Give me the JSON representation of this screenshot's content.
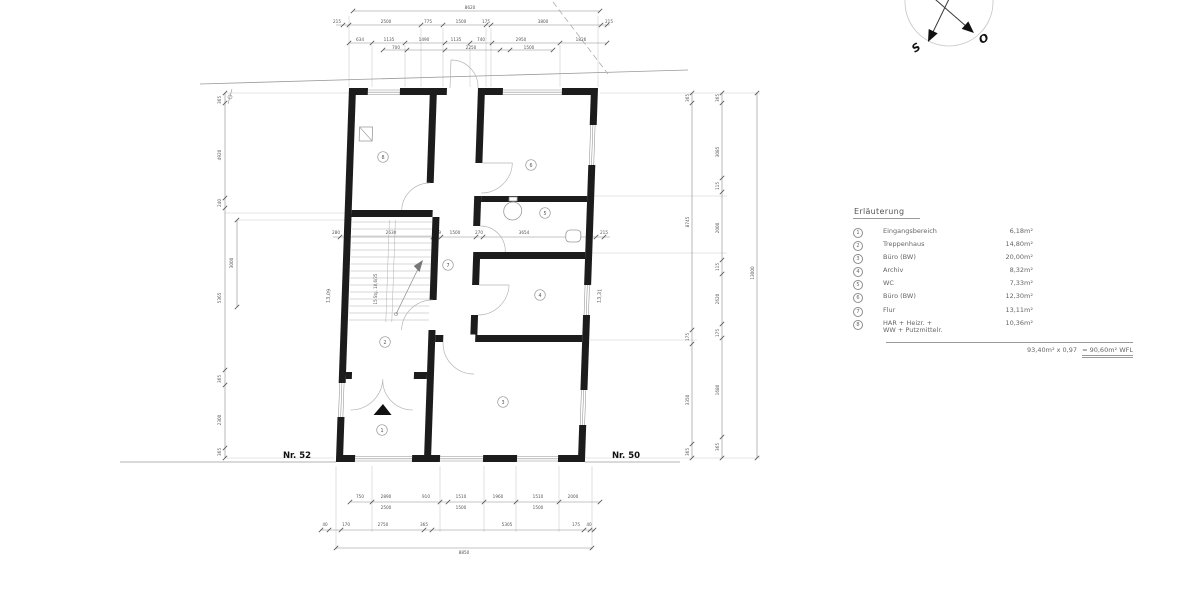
{
  "legend": {
    "title": "Erläuterung",
    "items": [
      {
        "no": "1",
        "label": "Eingangsbereich",
        "area": "6,18m²"
      },
      {
        "no": "2",
        "label": "Treppenhaus",
        "area": "14,80m²"
      },
      {
        "no": "3",
        "label": "Büro (BW)",
        "area": "20,00m²"
      },
      {
        "no": "4",
        "label": "Archiv",
        "area": "8,32m²"
      },
      {
        "no": "5",
        "label": "WC",
        "area": "7,33m²"
      },
      {
        "no": "6",
        "label": "Büro (BW)",
        "area": "12,30m²"
      },
      {
        "no": "7",
        "label": "Flur",
        "area": "13,11m²"
      },
      {
        "no": "8",
        "label": "HAR + Heizr. +\nWW + Putzmittelr.",
        "area": "10,36m²"
      }
    ],
    "total_left": "93,40m² x 0,97",
    "total_result": "= 90,60m² WFL"
  },
  "compass": {
    "south": "S",
    "east": "O"
  },
  "plan": {
    "rooms": [
      {
        "no": "1",
        "x": 382,
        "y": 430
      },
      {
        "no": "2",
        "x": 385,
        "y": 342
      },
      {
        "no": "3",
        "x": 503,
        "y": 402
      },
      {
        "no": "4",
        "x": 540,
        "y": 295
      },
      {
        "no": "5",
        "x": 545,
        "y": 213
      },
      {
        "no": "6",
        "x": 531,
        "y": 165
      },
      {
        "no": "7",
        "x": 448,
        "y": 265
      },
      {
        "no": "8",
        "x": 383,
        "y": 157
      }
    ]
  },
  "drawing": {
    "labels": [
      {
        "t": "8620",
        "x": 470,
        "y": 9
      },
      {
        "t": "215",
        "x": 337,
        "y": 23
      },
      {
        "t": "2500",
        "x": 386,
        "y": 23
      },
      {
        "t": "775",
        "x": 428,
        "y": 23
      },
      {
        "t": "1500",
        "x": 461,
        "y": 23
      },
      {
        "t": "175",
        "x": 486,
        "y": 23
      },
      {
        "t": "3800",
        "x": 543,
        "y": 23
      },
      {
        "t": "215",
        "x": 609,
        "y": 23
      },
      {
        "t": "634",
        "x": 360,
        "y": 41
      },
      {
        "t": "1135",
        "x": 389,
        "y": 41
      },
      {
        "t": "1490",
        "x": 424,
        "y": 41
      },
      {
        "t": "1135",
        "x": 456,
        "y": 41
      },
      {
        "t": "740",
        "x": 481,
        "y": 41
      },
      {
        "t": "2950",
        "x": 521,
        "y": 41
      },
      {
        "t": "1826",
        "x": 581,
        "y": 41
      },
      {
        "t": "700",
        "x": 396,
        "y": 49
      },
      {
        "t": "2250",
        "x": 471,
        "y": 49
      },
      {
        "t": "1500",
        "x": 529,
        "y": 49
      },
      {
        "t": "750",
        "x": 360,
        "y": 498
      },
      {
        "t": "2890",
        "x": 386,
        "y": 498
      },
      {
        "t": "910",
        "x": 426,
        "y": 498
      },
      {
        "t": "1510",
        "x": 461,
        "y": 498
      },
      {
        "t": "1960",
        "x": 498,
        "y": 498
      },
      {
        "t": "1510",
        "x": 538,
        "y": 498
      },
      {
        "t": "2000",
        "x": 573,
        "y": 498
      },
      {
        "t": "2500",
        "x": 386,
        "y": 509
      },
      {
        "t": "1500",
        "x": 461,
        "y": 509
      },
      {
        "t": "1500",
        "x": 538,
        "y": 509
      },
      {
        "t": "40",
        "x": 325,
        "y": 526
      },
      {
        "t": "170",
        "x": 346,
        "y": 526
      },
      {
        "t": "2750",
        "x": 383,
        "y": 526
      },
      {
        "t": "365",
        "x": 424,
        "y": 526
      },
      {
        "t": "5305",
        "x": 507,
        "y": 526
      },
      {
        "t": "175",
        "x": 576,
        "y": 526
      },
      {
        "t": "40",
        "x": 589,
        "y": 526
      },
      {
        "t": "8850",
        "x": 464,
        "y": 554
      },
      {
        "t": "365",
        "x": 221,
        "y": 100,
        "r": -90
      },
      {
        "t": "4920",
        "x": 221,
        "y": 155,
        "r": -90
      },
      {
        "t": "240",
        "x": 221,
        "y": 203,
        "r": -90
      },
      {
        "t": "5365",
        "x": 221,
        "y": 298,
        "r": -90
      },
      {
        "t": "365",
        "x": 221,
        "y": 379,
        "r": -90
      },
      {
        "t": "2300",
        "x": 221,
        "y": 420,
        "r": -90
      },
      {
        "t": "365",
        "x": 221,
        "y": 452,
        "r": -90
      },
      {
        "t": "3000",
        "x": 233,
        "y": 263,
        "r": -90
      },
      {
        "t": "365",
        "x": 689,
        "y": 98,
        "r": -90
      },
      {
        "t": "8745",
        "x": 689,
        "y": 222,
        "r": -90
      },
      {
        "t": "175",
        "x": 689,
        "y": 337,
        "r": -90
      },
      {
        "t": "3350",
        "x": 689,
        "y": 400,
        "r": -90
      },
      {
        "t": "365",
        "x": 689,
        "y": 452,
        "r": -90
      },
      {
        "t": "365",
        "x": 719,
        "y": 98,
        "r": -90
      },
      {
        "t": "3085",
        "x": 719,
        "y": 152,
        "r": -90
      },
      {
        "t": "115",
        "x": 719,
        "y": 186,
        "r": -90
      },
      {
        "t": "2000",
        "x": 719,
        "y": 228,
        "r": -90
      },
      {
        "t": "115",
        "x": 719,
        "y": 267,
        "r": -90
      },
      {
        "t": "2620",
        "x": 719,
        "y": 299,
        "r": -90
      },
      {
        "t": "175",
        "x": 719,
        "y": 333,
        "r": -90
      },
      {
        "t": "1680",
        "x": 719,
        "y": 390,
        "r": -90
      },
      {
        "t": "365",
        "x": 719,
        "y": 447,
        "r": -90
      },
      {
        "t": "13000",
        "x": 754,
        "y": 273,
        "r": -90
      },
      {
        "t": "280",
        "x": 336,
        "y": 234
      },
      {
        "t": "2630",
        "x": 391,
        "y": 234
      },
      {
        "t": "249",
        "x": 437,
        "y": 234
      },
      {
        "t": "1500",
        "x": 455,
        "y": 234
      },
      {
        "t": "270",
        "x": 479,
        "y": 234
      },
      {
        "t": "3654",
        "x": 524,
        "y": 234
      },
      {
        "t": "215",
        "x": 604,
        "y": 234
      },
      {
        "t": "13,09",
        "x": 330,
        "y": 296,
        "r": -87,
        "s": 5
      },
      {
        "t": "13,31",
        "x": 601,
        "y": 296,
        "r": -87,
        "s": 5
      },
      {
        "t": "15 Stg. 18,6/25",
        "x": 377,
        "y": 289,
        "r": -90,
        "s": 4
      },
      {
        "t": "Nr. 52",
        "x": 297,
        "y": 458,
        "s": 8.5,
        "b": 1,
        "c": "#111",
        "n": "house-number-left"
      },
      {
        "t": "Nr. 50",
        "x": 626,
        "y": 458,
        "s": 8.5,
        "b": 1,
        "c": "#111",
        "n": "house-number-right"
      }
    ],
    "ext": [
      [
        349,
        16,
        349,
        87
      ],
      [
        598,
        16,
        598,
        87
      ],
      [
        421,
        28,
        421,
        87
      ],
      [
        443,
        28,
        443,
        87
      ],
      [
        486,
        28,
        486,
        87
      ],
      [
        491,
        28,
        491,
        87
      ],
      [
        372,
        45,
        372,
        87
      ],
      [
        405,
        45,
        405,
        87
      ],
      [
        470,
        45,
        470,
        87
      ],
      [
        560,
        45,
        560,
        87
      ],
      [
        336,
        466,
        336,
        550
      ],
      [
        592,
        466,
        592,
        550
      ],
      [
        372,
        466,
        372,
        532
      ],
      [
        440,
        466,
        440,
        532
      ],
      [
        484,
        466,
        484,
        532
      ],
      [
        516,
        466,
        516,
        532
      ],
      [
        559,
        466,
        559,
        532
      ],
      [
        225,
        93,
        352,
        93
      ],
      [
        225,
        213,
        349,
        213
      ],
      [
        225,
        458,
        334,
        458
      ],
      [
        237,
        220,
        352,
        220
      ],
      [
        600,
        93,
        760,
        93
      ],
      [
        592,
        196,
        727,
        196
      ],
      [
        590,
        253,
        727,
        253
      ],
      [
        590,
        340,
        697,
        340
      ],
      [
        585,
        458,
        760,
        458
      ]
    ],
    "chains": [
      [
        353,
        11,
        600,
        11
      ],
      [
        336,
        25,
        610,
        25
      ],
      [
        349,
        43,
        607,
        43
      ],
      [
        383,
        50,
        553,
        50
      ],
      [
        350,
        502,
        600,
        502
      ],
      [
        320,
        530,
        595,
        530
      ],
      [
        336,
        548,
        592,
        548
      ],
      [
        225,
        93,
        225,
        458
      ],
      [
        237,
        220,
        237,
        307
      ],
      [
        692,
        93,
        692,
        458
      ],
      [
        722,
        93,
        722,
        458
      ],
      [
        757,
        93,
        757,
        458
      ],
      [
        333,
        237,
        610,
        237
      ]
    ],
    "siteLines": [
      [
        200,
        84,
        688,
        70
      ],
      [
        120,
        462,
        336,
        462
      ],
      [
        585,
        462,
        680,
        462
      ]
    ],
    "dashedLines": [
      [
        553,
        2,
        608,
        74
      ]
    ],
    "ticks": [
      [
        353,
        11
      ],
      [
        600,
        11
      ],
      [
        343,
        25
      ],
      [
        349,
        25
      ],
      [
        421,
        25
      ],
      [
        443,
        25
      ],
      [
        486,
        25
      ],
      [
        491,
        25
      ],
      [
        601,
        25
      ],
      [
        607,
        25
      ],
      [
        349,
        43
      ],
      [
        372,
        43
      ],
      [
        405,
        43
      ],
      [
        445,
        43
      ],
      [
        470,
        43
      ],
      [
        492,
        43
      ],
      [
        560,
        43
      ],
      [
        607,
        43
      ],
      [
        383,
        50
      ],
      [
        407,
        50
      ],
      [
        445,
        50
      ],
      [
        500,
        50
      ],
      [
        510,
        50
      ],
      [
        553,
        50
      ],
      [
        350,
        502
      ],
      [
        372,
        502
      ],
      [
        440,
        502
      ],
      [
        448,
        502
      ],
      [
        484,
        502
      ],
      [
        516,
        502
      ],
      [
        559,
        502
      ],
      [
        600,
        502
      ],
      [
        321,
        530
      ],
      [
        329,
        530
      ],
      [
        341,
        530
      ],
      [
        424,
        530
      ],
      [
        432,
        530
      ],
      [
        584,
        530
      ],
      [
        590,
        530
      ],
      [
        594,
        530
      ],
      [
        336,
        548
      ],
      [
        592,
        548
      ],
      [
        225,
        93
      ],
      [
        225,
        103
      ],
      [
        225,
        198
      ],
      [
        225,
        208
      ],
      [
        225,
        370
      ],
      [
        225,
        385
      ],
      [
        225,
        448
      ],
      [
        225,
        458
      ],
      [
        237,
        220
      ],
      [
        237,
        307
      ],
      [
        692,
        93
      ],
      [
        692,
        103
      ],
      [
        692,
        330
      ],
      [
        692,
        344
      ],
      [
        692,
        444
      ],
      [
        692,
        458
      ],
      [
        722,
        93
      ],
      [
        722,
        103
      ],
      [
        722,
        178
      ],
      [
        722,
        192
      ],
      [
        722,
        260
      ],
      [
        722,
        274
      ],
      [
        722,
        324
      ],
      [
        722,
        338
      ],
      [
        722,
        437
      ],
      [
        722,
        458
      ],
      [
        757,
        93
      ],
      [
        757,
        458
      ],
      [
        340,
        237
      ],
      [
        347,
        237
      ],
      [
        433,
        237
      ],
      [
        441,
        237
      ],
      [
        476,
        237
      ],
      [
        483,
        237
      ],
      [
        588,
        237
      ],
      [
        596,
        237
      ],
      [
        604,
        237
      ]
    ]
  }
}
